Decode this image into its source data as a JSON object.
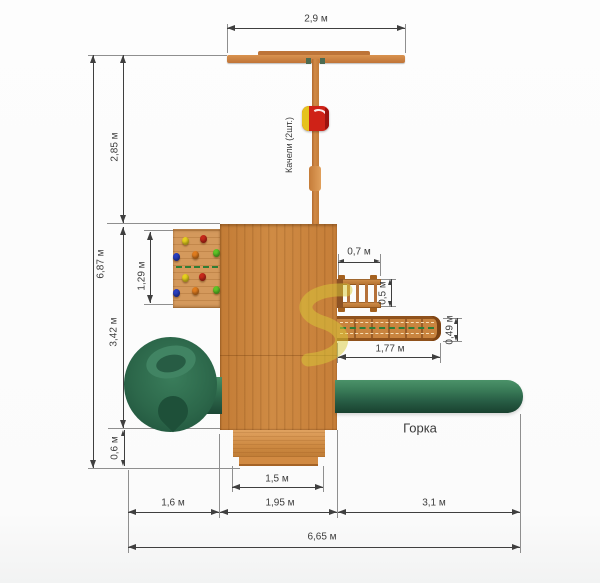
{
  "drawing": {
    "type": "playground-top-view-blueprint",
    "units": "м"
  },
  "dimensions": {
    "top_width": "2,9 м",
    "left_upper": "2,85 м",
    "total_height": "6,87 м",
    "left_middle": "3,42 м",
    "left_lower": "0,6 м",
    "climb_wall_height": "1,29 м",
    "ladder_width": "0,7 м",
    "ladder_depth": "0,5 м",
    "walkway_depth": "0,49 м",
    "walkway_length": "1,77 м",
    "step_width": "1,5 м",
    "bottom_left": "1,6 м",
    "bottom_middle": "1,95 м",
    "bottom_right": "3,1 м",
    "total_width": "6,65 м"
  },
  "labels": {
    "swing": "Качели (2шт.)",
    "slide": "Горка"
  },
  "colors": {
    "wood": "#cd8a44",
    "wood_dark": "#b06a30",
    "wood_light": "#d4995c",
    "slide_green": "#2c674a",
    "slide_green_dark": "#1d4e39",
    "seat_red": "#cf2217",
    "seat_yellow": "#e5c31d",
    "dash_green": "#2f7d35",
    "dim_line": "#3f3f3f",
    "extension_line": "#8f8f8f",
    "watermark": "#d9cb39"
  },
  "climbing_holds": [
    {
      "x": 185,
      "y": 241,
      "color": "#e6cf1f",
      "color_name": "yellow"
    },
    {
      "x": 203,
      "y": 239,
      "color": "#c6281a",
      "color_name": "red"
    },
    {
      "x": 176,
      "y": 257,
      "color": "#2a3fbf",
      "color_name": "blue"
    },
    {
      "x": 195,
      "y": 255,
      "color": "#e07c1e",
      "color_name": "orange"
    },
    {
      "x": 216,
      "y": 253,
      "color": "#5fc427",
      "color_name": "green"
    },
    {
      "x": 185,
      "y": 278,
      "color": "#e6cf1f",
      "color_name": "yellow"
    },
    {
      "x": 202,
      "y": 277,
      "color": "#c6281a",
      "color_name": "red"
    },
    {
      "x": 176,
      "y": 293,
      "color": "#2a3fbf",
      "color_name": "blue"
    },
    {
      "x": 195,
      "y": 291,
      "color": "#e07c1e",
      "color_name": "orange"
    },
    {
      "x": 216,
      "y": 290,
      "color": "#5fc427",
      "color_name": "green"
    }
  ]
}
